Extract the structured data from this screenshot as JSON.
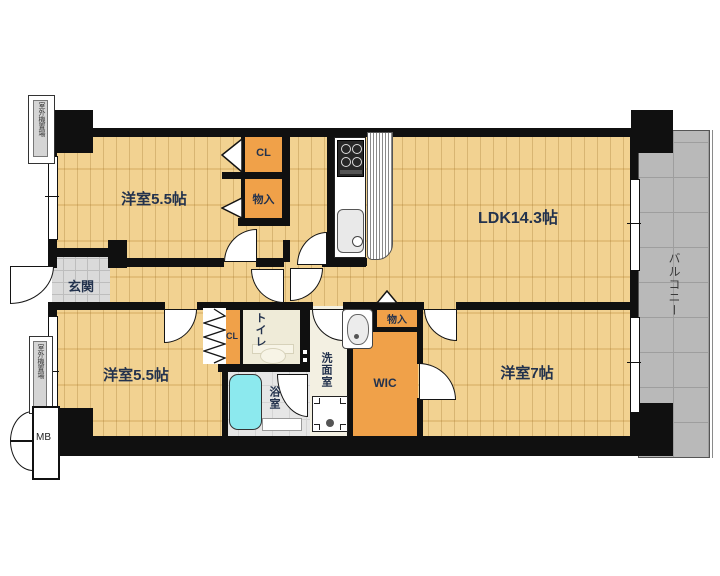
{
  "rooms": {
    "bedroom_top_left": {
      "label": "洋室5.5帖"
    },
    "bedroom_bottom_left": {
      "label": "洋室5.5帖"
    },
    "bedroom_bottom_right": {
      "label": "洋室7帖"
    },
    "ldk": {
      "label": "LDK14.3帖"
    },
    "entrance": {
      "label": "玄関"
    },
    "toilet": {
      "label": "トイレ"
    },
    "bathroom": {
      "label": "浴室"
    },
    "washroom": {
      "label": "洗面室"
    },
    "wic": {
      "label": "WIC"
    },
    "closet_top": {
      "label": "CL"
    },
    "closet_bottom": {
      "label": "CL"
    },
    "storage_top": {
      "label": "物入"
    },
    "storage_bottom": {
      "label": "物入"
    },
    "balcony": {
      "label": "バルコニー"
    },
    "meter_box": {
      "label": "MB"
    },
    "outdoor_unit_top": {
      "label": "室外機置場"
    },
    "outdoor_unit_bottom": {
      "label": "室外機置場"
    }
  },
  "colors": {
    "floor_wood": "#f1cd85",
    "closet_orange": "#f0a149",
    "balcony_gray": "#b9b9b9",
    "bathtub_cyan": "#8ce9ee",
    "wall_black": "#101010",
    "label_navy": "#23324d"
  }
}
